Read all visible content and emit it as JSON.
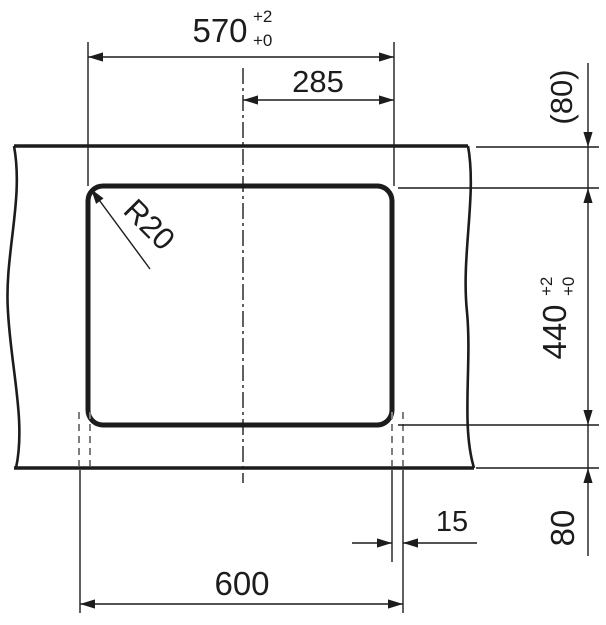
{
  "colors": {
    "line": "#1c1c1c",
    "hidden": "#7e7e7e",
    "background": "#ffffff"
  },
  "dimensions": {
    "cutout_width": {
      "value": "570",
      "tol_plus": "+2",
      "tol_minus": "+0"
    },
    "center_to_edge": {
      "value": "285"
    },
    "back_offset": {
      "value": "(80)"
    },
    "cutout_depth": {
      "value": "440",
      "tol_plus": "+2",
      "tol_minus": "+0"
    },
    "front_offset": {
      "value": "80"
    },
    "side_overhang": {
      "value": "15"
    },
    "sink_width": {
      "value": "600"
    },
    "corner_radius": {
      "value": "R20"
    }
  }
}
